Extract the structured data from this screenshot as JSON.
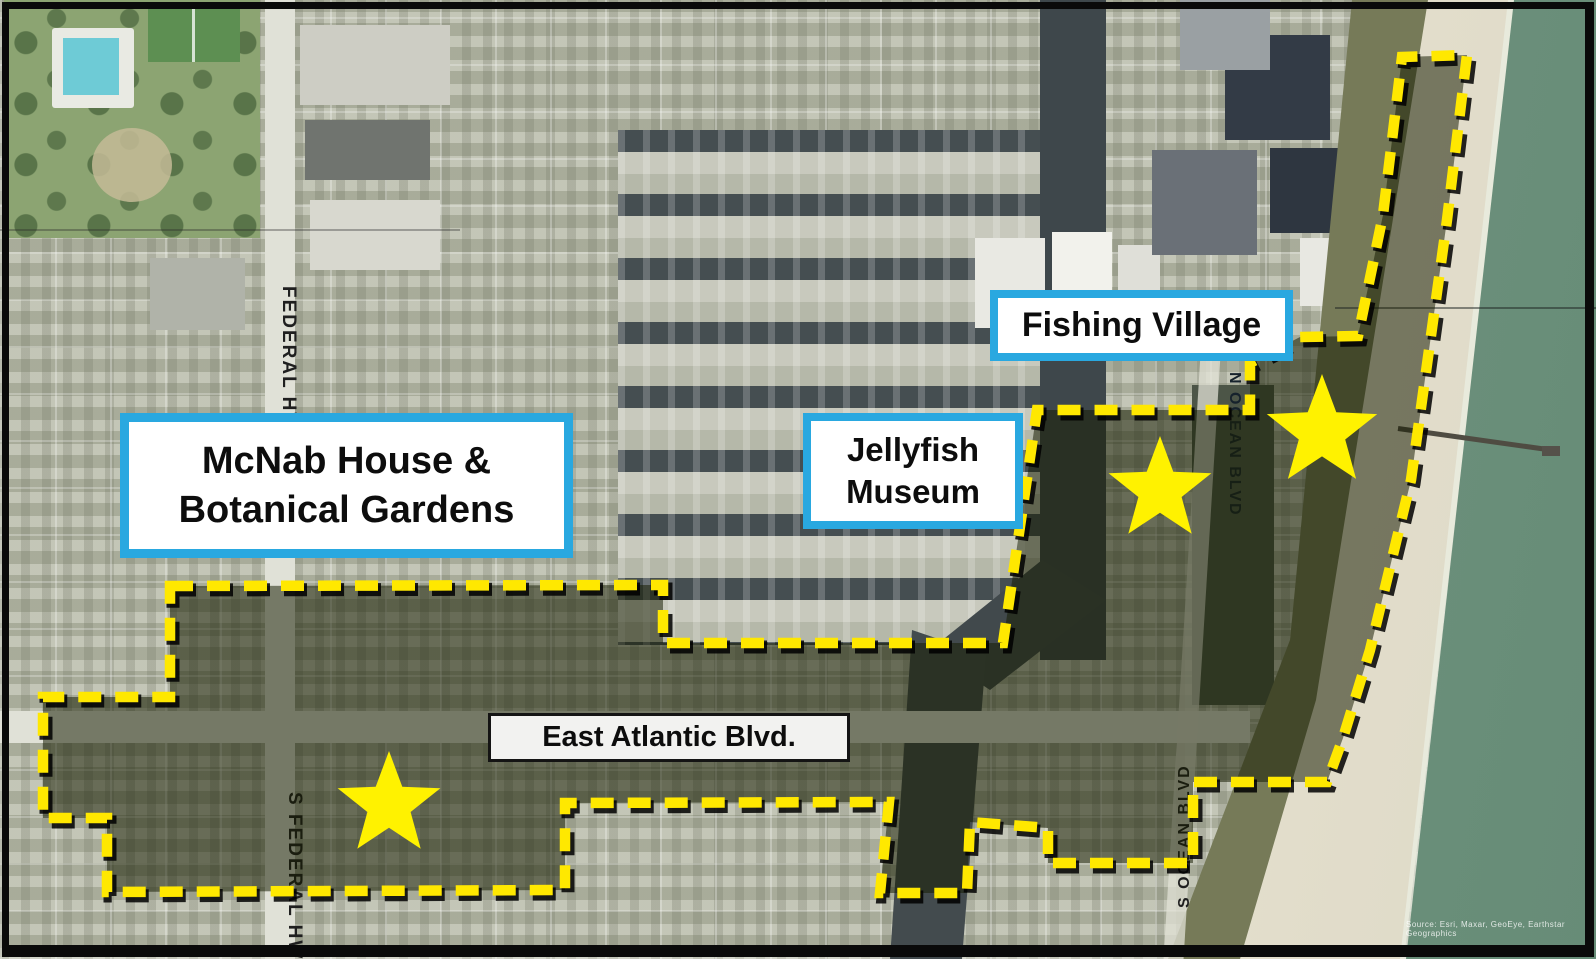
{
  "labels": {
    "mcnab": {
      "line1": "McNab House &",
      "line2": "Botanical Gardens"
    },
    "jellyfish": {
      "line1": "Jellyfish",
      "line2": "Museum"
    },
    "fishing_village": {
      "text": "Fishing Village"
    },
    "east_atlantic": {
      "text": "East Atlantic Blvd."
    }
  },
  "road_labels": {
    "federal_hwy": "FEDERAL HWY",
    "s_federal_hwy": "S FEDERAL HWY",
    "n_ocean_blvd": "N OCEAN BLVD",
    "s_ocean_blvd": "S OCEAN BLVD"
  },
  "attribution": "Source: Esri, Maxar, GeoEye, Earthstar Geographics",
  "colors": {
    "boundary_yellow": "#ffe800",
    "boundary_shadow": "#000000",
    "star_yellow": "#fff200",
    "label_border_blue": "#29a8e0",
    "label_bg": "#ffffff",
    "street_label_bg": "#f2f2f0",
    "shade_overlay": "rgba(22,28,2,0.53)",
    "ocean": "#6f937f",
    "sand": "#ded9c6"
  },
  "district": {
    "boundary_points": [
      [
        170,
        586
      ],
      [
        663,
        585
      ],
      [
        663,
        643
      ],
      [
        1003,
        643
      ],
      [
        1037,
        410
      ],
      [
        1250,
        410
      ],
      [
        1250,
        363
      ],
      [
        1300,
        337
      ],
      [
        1358,
        336
      ],
      [
        1383,
        215
      ],
      [
        1402,
        57
      ],
      [
        1467,
        55
      ],
      [
        1447,
        220
      ],
      [
        1411,
        480
      ],
      [
        1370,
        650
      ],
      [
        1343,
        738
      ],
      [
        1327,
        782
      ],
      [
        1193,
        782
      ],
      [
        1193,
        863
      ],
      [
        1048,
        863
      ],
      [
        1048,
        828
      ],
      [
        970,
        822
      ],
      [
        967,
        893
      ],
      [
        880,
        893
      ],
      [
        889,
        802
      ],
      [
        565,
        803
      ],
      [
        565,
        890
      ],
      [
        107,
        892
      ],
      [
        107,
        818
      ],
      [
        43,
        818
      ],
      [
        43,
        697
      ],
      [
        170,
        697
      ]
    ]
  },
  "markers": {
    "stars": [
      {
        "x": 1160,
        "y": 490,
        "r": 54
      },
      {
        "x": 1322,
        "y": 432,
        "r": 58
      },
      {
        "x": 389,
        "y": 805,
        "r": 54
      }
    ]
  }
}
